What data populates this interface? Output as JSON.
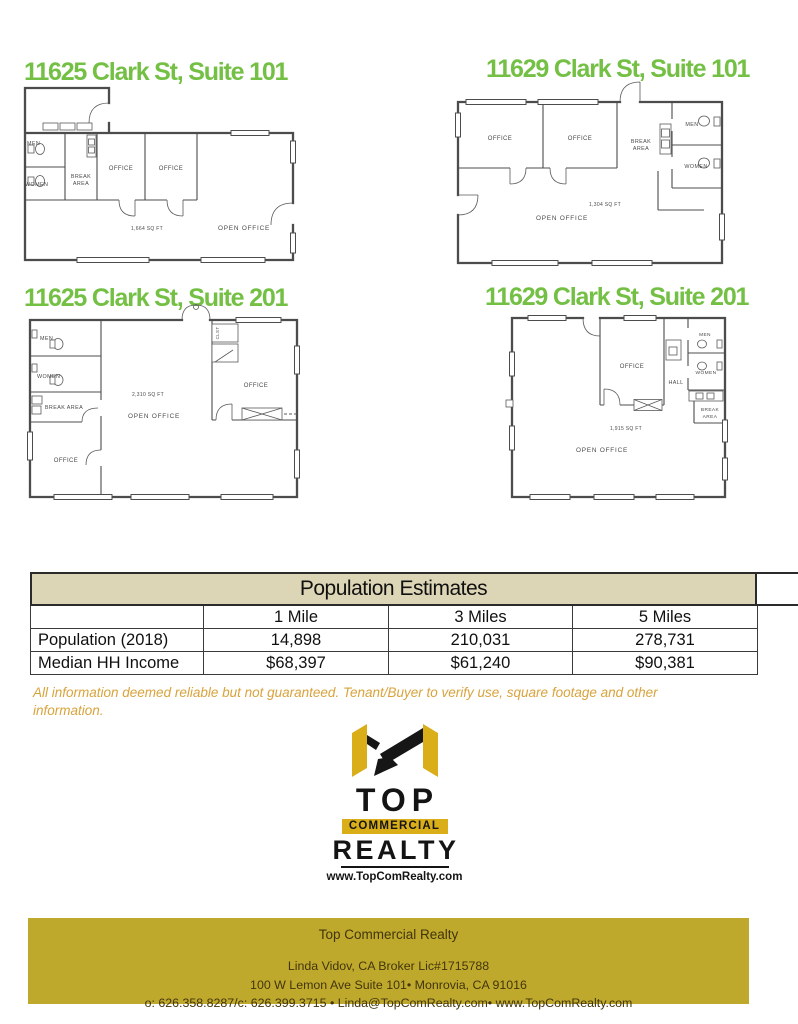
{
  "colors": {
    "title_green": "#74c044",
    "table_header_bg": "#ddd6b6",
    "footer_bg": "#bfa92d",
    "disclaimer_text": "#d9a33c",
    "logo_gold": "#d9ae19"
  },
  "plans": [
    {
      "title": "11625 Clark St, Suite 101",
      "labels": {
        "men": "MEN",
        "women": "WOMEN",
        "break_l1": "BREAK",
        "break_l2": "AREA",
        "office_a": "OFFICE",
        "office_b": "OFFICE",
        "sqft": "1,664 SQ FT",
        "open_office": "OPEN OFFICE"
      }
    },
    {
      "title": "11629 Clark St, Suite 101",
      "labels": {
        "office_a": "OFFICE",
        "office_b": "OFFICE",
        "break_l1": "BREAK",
        "break_l2": "AREA",
        "men": "MEN",
        "women": "WOMEN",
        "sqft": "1,304 SQ FT",
        "open_office": "OPEN OFFICE"
      }
    },
    {
      "title": "11625 Clark St, Suite 201",
      "labels": {
        "men": "MEN",
        "women": "WOMEN",
        "break": "BREAK AREA",
        "office_left": "OFFICE",
        "office_right": "OFFICE",
        "clst": "CLST",
        "sqft": "2,310 SQ FT",
        "open_office": "OPEN OFFICE"
      }
    },
    {
      "title": "11629 Clark St, Suite 201",
      "labels": {
        "office": "OFFICE",
        "hall": "HALL",
        "men": "MEN",
        "women": "WOMEN",
        "break_l1": "BREAK",
        "break_l2": "AREA",
        "sqft": "1,915 SQ FT",
        "open_office": "OPEN OFFICE"
      }
    }
  ],
  "table": {
    "title": "Population Estimates",
    "columns": [
      "",
      "1 Mile",
      "3 Miles",
      "5 Miles"
    ],
    "rows": [
      {
        "label": "Population (2018)",
        "values": [
          "14,898",
          "210,031",
          "278,731"
        ]
      },
      {
        "label": "Median HH Income",
        "values": [
          "$68,397",
          "$61,240",
          "$90,381"
        ]
      }
    ]
  },
  "disclaimer": "All information deemed reliable but not guaranteed. Tenant/Buyer to verify use, square footage and other information.",
  "logo": {
    "top": "TOP",
    "commercial": "COMMERCIAL",
    "realty": "REALTY",
    "website": "www.TopComRealty.com"
  },
  "footer": {
    "company": "Top Commercial Realty",
    "broker": "Linda Vidov, CA Broker Lic#1715788",
    "address": "100 W Lemon Ave Suite 101• Monrovia, CA  91016",
    "contact": "o: 626.358.8287/c: 626.399.3715 • Linda@TopComRealty.com• www.TopComRealty.com"
  }
}
